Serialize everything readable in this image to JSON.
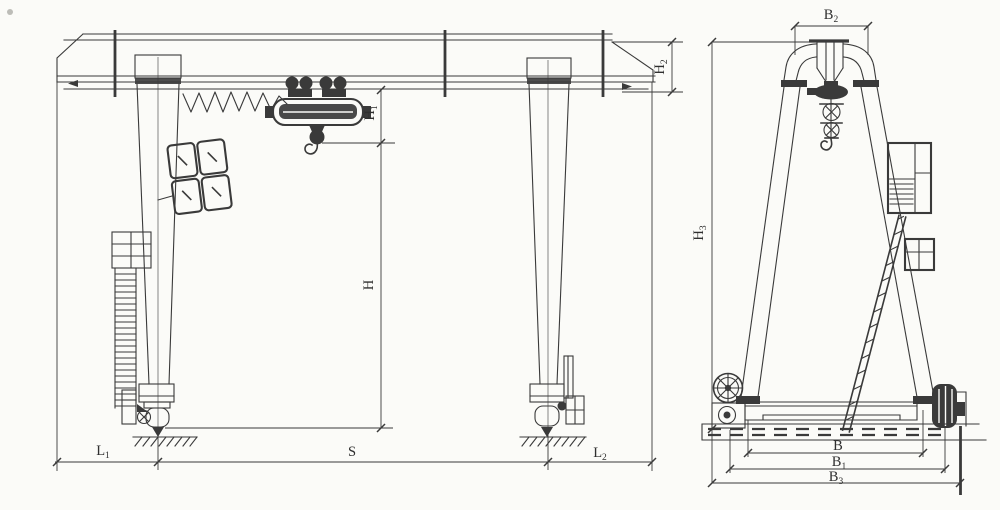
{
  "colors": {
    "line": "#3a3a3a",
    "background": "#fbfbf8",
    "text": "#2f2f2f"
  },
  "labels": {
    "L1": {
      "base": "L",
      "sub": "1"
    },
    "S": {
      "base": "S",
      "sub": ""
    },
    "L2": {
      "base": "L",
      "sub": "2"
    },
    "H": {
      "base": "H",
      "sub": ""
    },
    "H1": {
      "base": "H",
      "sub": "1"
    },
    "H2": {
      "base": "H",
      "sub": "2"
    },
    "H3": {
      "base": "H",
      "sub": "3"
    },
    "B": {
      "base": "B",
      "sub": ""
    },
    "B1": {
      "base": "B",
      "sub": "1"
    },
    "B2": {
      "base": "B",
      "sub": "2"
    },
    "B3": {
      "base": "B",
      "sub": "3"
    }
  }
}
